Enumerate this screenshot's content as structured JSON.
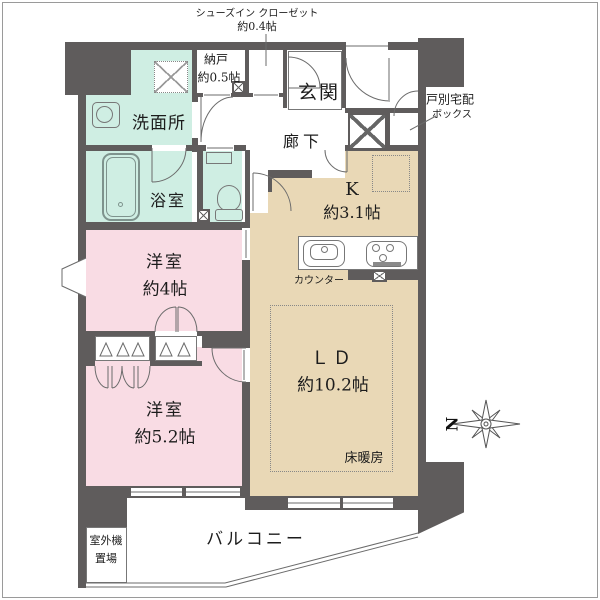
{
  "colors": {
    "wall": "#5f5c5c",
    "wet_rooms": "#cfeee3",
    "bedrooms": "#f9dce4",
    "living_kitchen": "#e9d8b6",
    "lines": "#6b6b6b"
  },
  "labels": {
    "sic_l1": "シューズイン クローゼット",
    "sic_l2": "約0.4帖",
    "nando": "納戸",
    "nando_size": "約0.5帖",
    "genkan": "玄関",
    "delivery_l1": "戸別宅配",
    "delivery_l2": "ボックス",
    "corridor": "廊下",
    "washroom": "洗面所",
    "bathroom": "浴室",
    "kitchen": "K",
    "kitchen_size": "約3.1帖",
    "counter": "カウンター",
    "living": "ＬＤ",
    "living_size": "約10.2帖",
    "floor_heating": "床暖房",
    "bedroom1": "洋室",
    "bedroom1_size": "約4帖",
    "bedroom2": "洋室",
    "bedroom2_size": "約5.2帖",
    "balcony": "バルコニー",
    "outdoor_l1": "室外機",
    "outdoor_l2": "置場",
    "north": "N"
  }
}
